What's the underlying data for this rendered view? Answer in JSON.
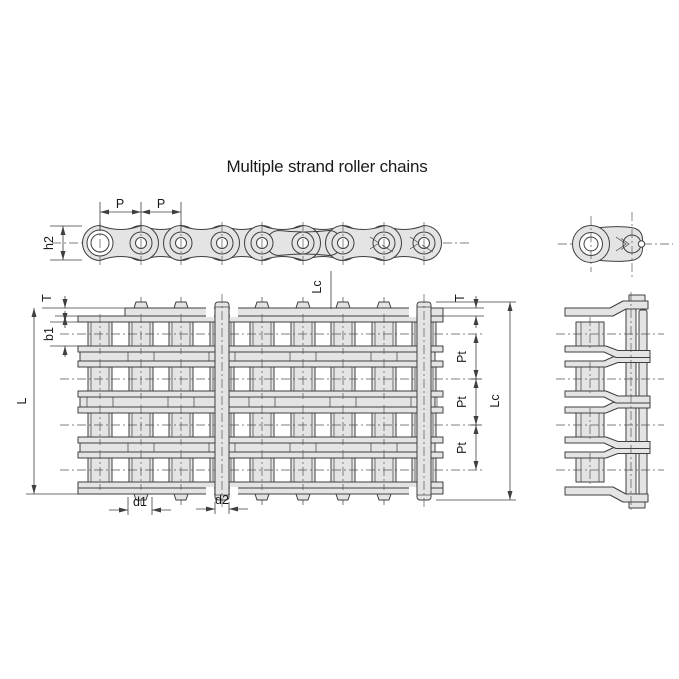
{
  "title": "Multiple strand roller chains",
  "colors": {
    "fill": "#e4e4e4",
    "line": "#3f3f3f",
    "centerline": "#565656",
    "text": "#1a1a1a",
    "background": "#ffffff"
  },
  "views": {
    "single_strand_side": {
      "pitch_1": "P",
      "pitch_2": "P",
      "plate_height": "h2"
    },
    "multi_strand_plan": {
      "plate_thickness_left": "T",
      "plate_thickness_right": "T",
      "inner_width": "b1",
      "pin_length": "L",
      "pin_length_cotter_top": "Lc",
      "pin_length_cotter_right": "Lc",
      "transverse_pitch_1": "Pt",
      "transverse_pitch_2": "Pt",
      "transverse_pitch_3": "Pt",
      "roller_diameter": "d1",
      "pin_diameter": "d2"
    }
  }
}
